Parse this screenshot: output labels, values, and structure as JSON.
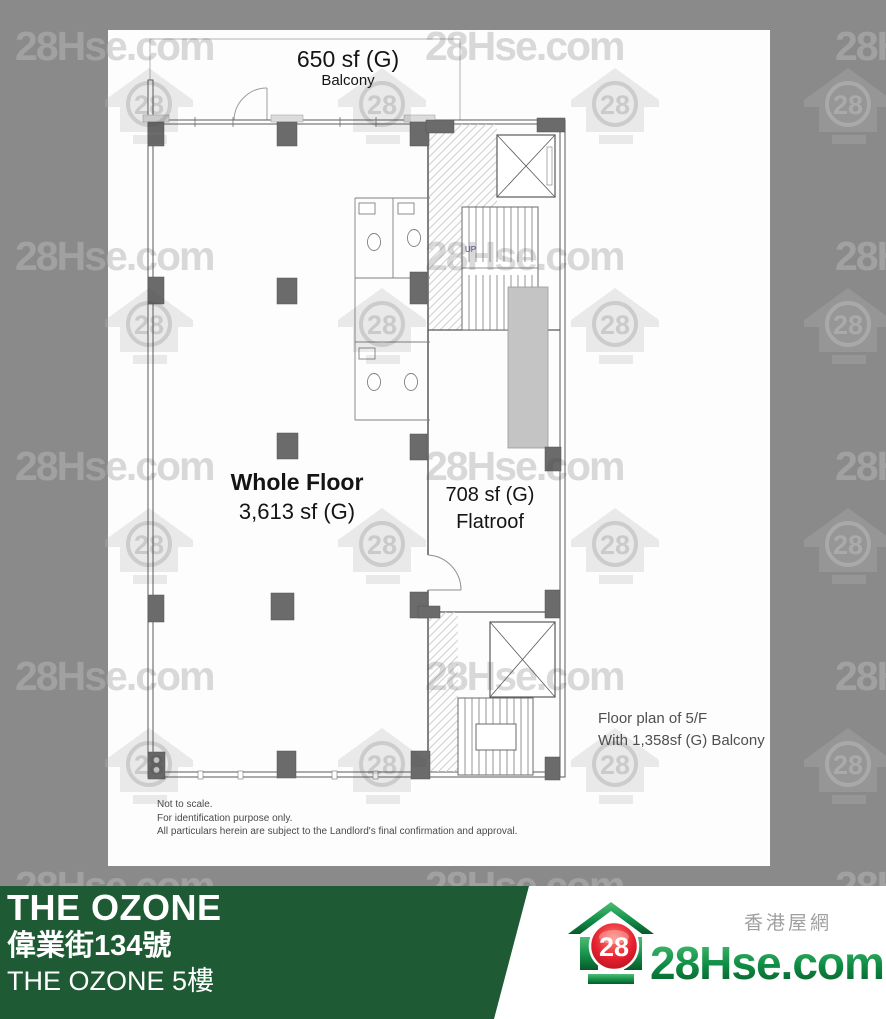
{
  "watermark": {
    "text": "28Hse.com",
    "badge": "28"
  },
  "colors": {
    "background_gray": "#8a8a8a",
    "banner_green": "#1e5a34",
    "logo_green": "#0e8c44",
    "logo_red": "#d5101f"
  },
  "plan": {
    "balcony_size": "650 sf (G)",
    "balcony_label": "Balcony",
    "main_area_title": "Whole Floor",
    "main_area_size": "3,613 sf (G)",
    "flatroof_size": "708 sf (G)",
    "flatroof_label": "Flatroof",
    "up_label": "UP",
    "note_line1": "Floor plan of 5/F",
    "note_line2": "With 1,358sf (G) Balcony",
    "disclaimer": [
      "Not to scale.",
      "For identification purpose only.",
      "All particulars herein are subject to the Landlord's final confirmation and approval."
    ]
  },
  "banner": {
    "title": "THE OZONE",
    "address": "偉業街134號",
    "subtitle": "THE OZONE 5樓"
  },
  "logo": {
    "brand": "28Hse.com",
    "badge": "28",
    "tagline": "香港屋網"
  }
}
